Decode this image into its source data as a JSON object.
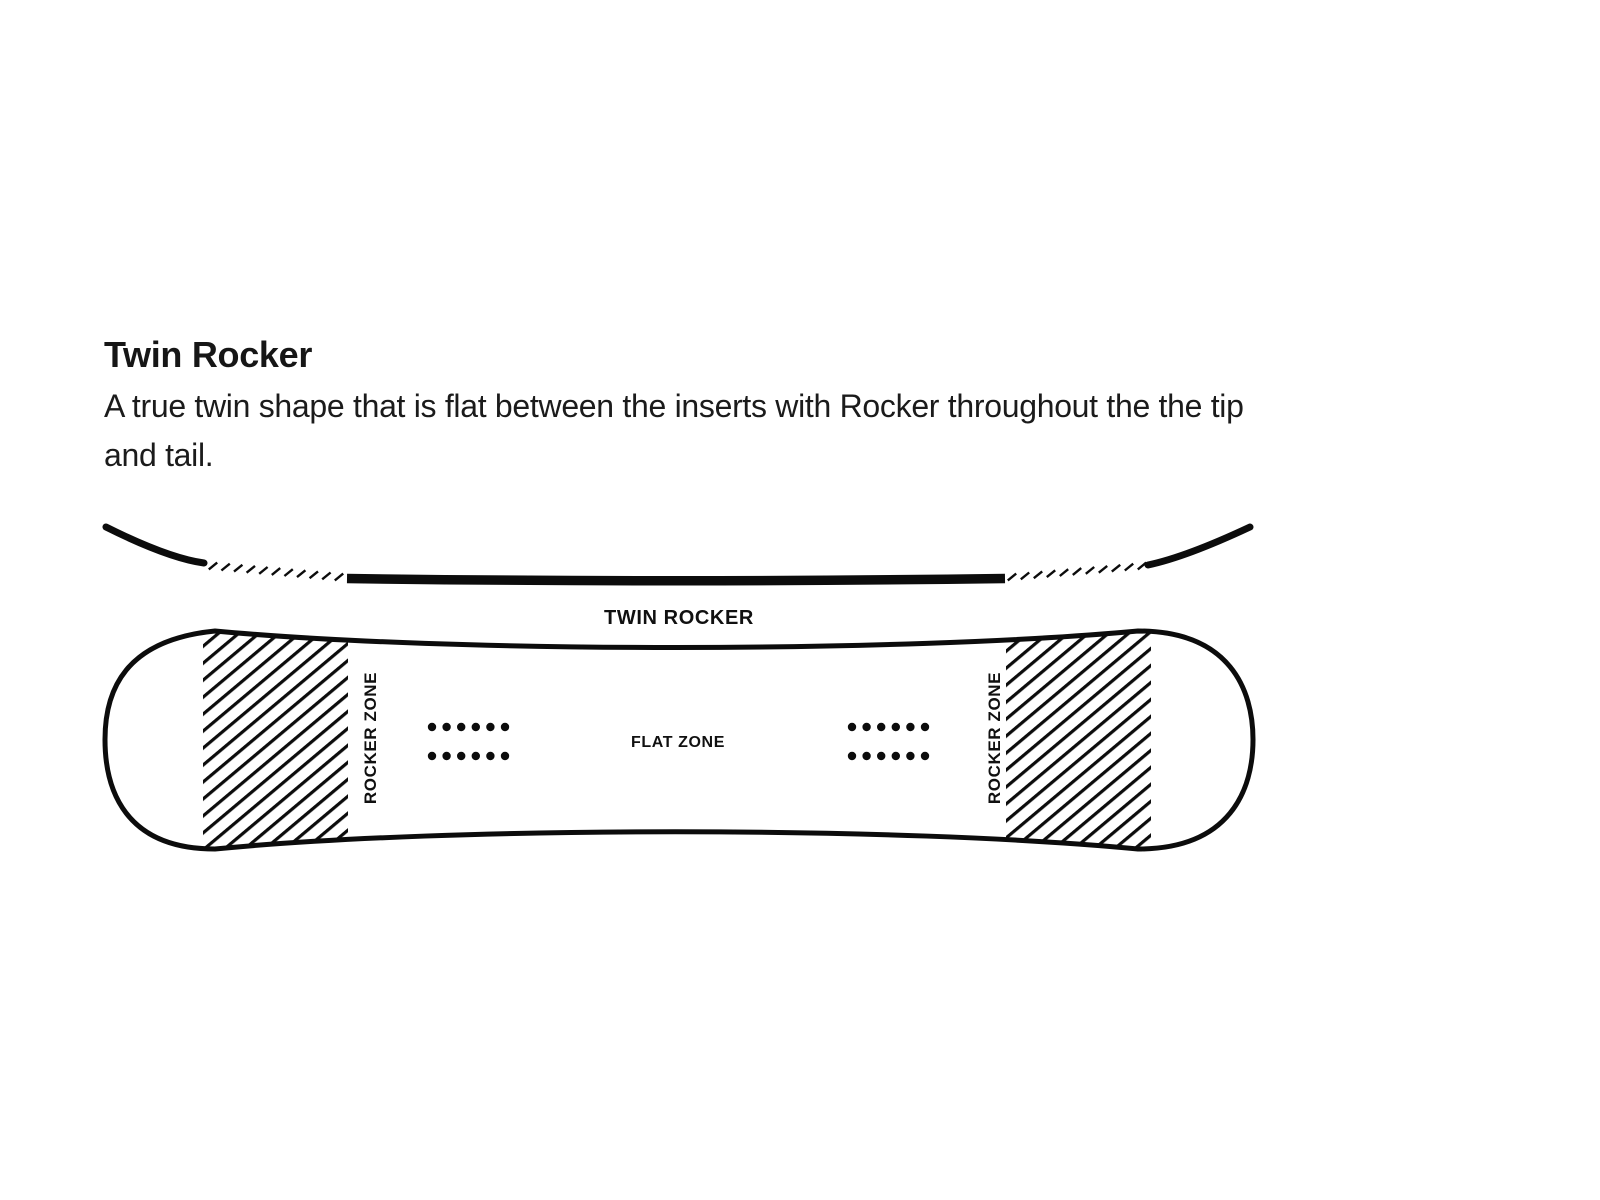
{
  "heading": {
    "title": "Twin Rocker",
    "description_lines": [
      "A true twin shape that is flat between the inserts with Rocker throughout the the tip",
      "and tail."
    ]
  },
  "labels": {
    "profile": "TWIN ROCKER",
    "flat_zone": "FLAT ZONE",
    "rocker_zone": "ROCKER ZONE"
  },
  "diagram": {
    "profile_segments": [
      "rocker tip curve",
      "rocker transition dashes",
      "flat center bar",
      "rocker transition dashes",
      "rocker tail curve"
    ],
    "insert_dots": {
      "groups": 2,
      "rows": 2,
      "cols": 6
    }
  },
  "colors": {
    "background": "#ffffff",
    "ink": "#0c0c0c",
    "text": "#1b1b1b"
  }
}
